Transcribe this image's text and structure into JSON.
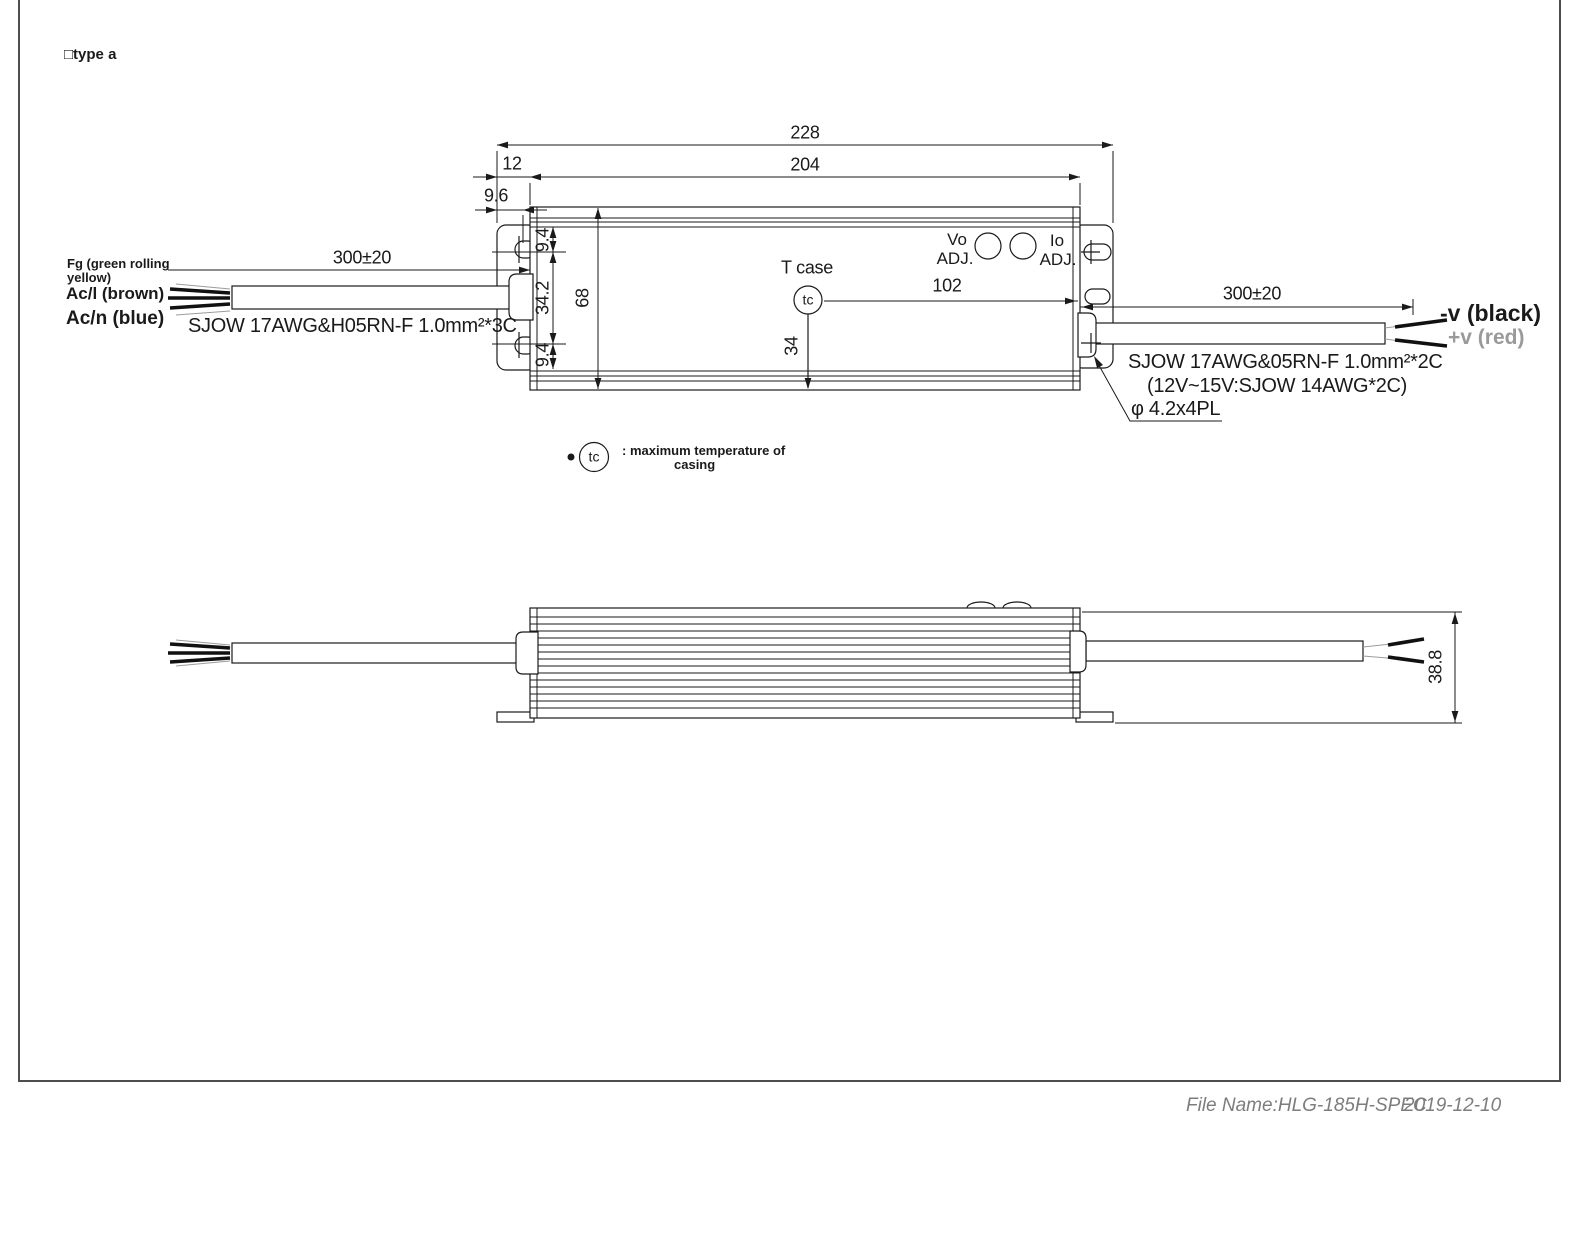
{
  "page": {
    "type_label": "□type a"
  },
  "top_view": {
    "dims": {
      "overall_length": "228",
      "body_length": "204",
      "bracket_offset": "12",
      "slot_offset": "9.6",
      "input_cable_length": "300±20",
      "slot_top": "9.4",
      "slot_span": "34.2",
      "slot_bottom": "9.4",
      "body_width": "68",
      "tc_horizontal": "102",
      "tc_vertical": "34",
      "output_cable_length": "300±20",
      "mounting_hole": "φ 4.2x4PL"
    },
    "labels": {
      "t_case": "T case",
      "tc": "tc",
      "vo": "Vo",
      "vo_adj": "ADJ.",
      "io": "Io",
      "io_adj": "ADJ."
    },
    "input": {
      "fg_line1": "Fg (green rolling",
      "fg_line2": "yellow)",
      "acl": "Ac/l (brown)",
      "acn": "Ac/n (blue)",
      "cable_spec": "SJOW 17AWG&H05RN-F 1.0mm²*3C"
    },
    "output": {
      "neg": "-v (black)",
      "pos": "+v (red)",
      "cable_spec": "SJOW 17AWG&05RN-F 1.0mm²*2C",
      "cable_note": "(12V~15V:SJOW 14AWG*2C)"
    }
  },
  "legend": {
    "tc": "tc",
    "line1": ": maximum temperature of",
    "line2": "casing"
  },
  "side_view": {
    "dims": {
      "height": "38.8"
    }
  },
  "footer": {
    "file_name": "File Name:HLG-185H-SPEC",
    "date": "2019-12-10"
  },
  "colors": {
    "drawing_line": "#1a1a1a",
    "muted_label": "#9a9a9a",
    "footer_text": "#7d7d7d"
  }
}
